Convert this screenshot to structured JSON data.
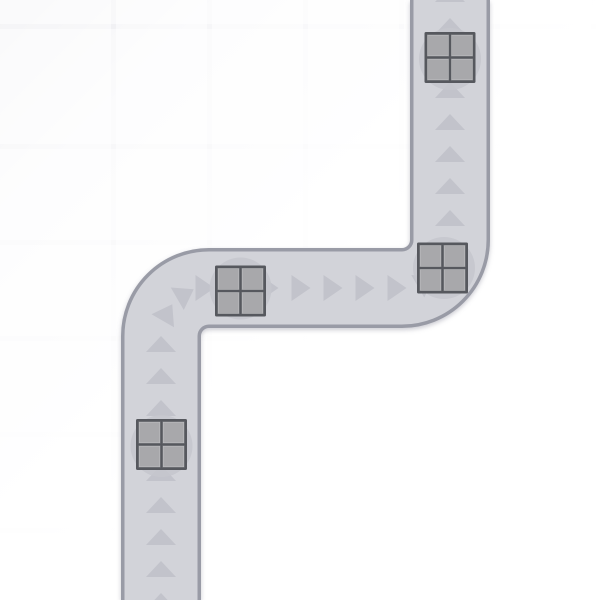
{
  "scene": {
    "canvas": {
      "width": 600,
      "height": 600
    },
    "colors": {
      "background_corner": "#e8e8ec",
      "background_mid": "#f6f6f8",
      "background": "#ffffff",
      "grid_cell_white": "rgba(255,255,255,0.5)",
      "road_fill": "#d2d3d9",
      "road_border": "#999ba6",
      "road_shadow": "#7d7d90",
      "arrow": "#c2c3cb",
      "pad_circle": "#c5c6cd",
      "crate_frame": "#56585e",
      "crate_panel": "#a8a8ab",
      "crate_panel_highlight": "rgba(255,255,255,0.25)"
    },
    "grid": {
      "cell_size": 96,
      "line_width": 5,
      "offset_x": 15,
      "offset_y": 48
    },
    "road": {
      "centerline": "M161,600 L161,336 A48,48 0 0 1 209,288 L402,288 A48,48 0 0 0 450,240 L450,0",
      "width": 73,
      "border_width": 80,
      "corner_radius": 48
    },
    "arrows": {
      "shape_up": {
        "width": 30,
        "height": 16
      },
      "shape_right": {
        "width": 19,
        "height": 26
      },
      "items": [
        {
          "x": 450,
          "y": -6,
          "dir": "up",
          "rot": 0
        },
        {
          "x": 450,
          "y": 26,
          "dir": "up",
          "rot": 0
        },
        {
          "x": 450,
          "y": 58,
          "dir": "up",
          "rot": 0
        },
        {
          "x": 450,
          "y": 90,
          "dir": "up",
          "rot": 0
        },
        {
          "x": 450,
          "y": 122,
          "dir": "up",
          "rot": 0
        },
        {
          "x": 450,
          "y": 154,
          "dir": "up",
          "rot": 0
        },
        {
          "x": 450,
          "y": 186,
          "dir": "up",
          "rot": 0
        },
        {
          "x": 450,
          "y": 218,
          "dir": "up",
          "rot": 0
        },
        {
          "x": 443.5,
          "y": 264,
          "dir": "right",
          "rot": -60
        },
        {
          "x": 426,
          "y": 281.5,
          "dir": "right",
          "rot": -30
        },
        {
          "x": 397,
          "y": 288,
          "dir": "right",
          "rot": 0
        },
        {
          "x": 365,
          "y": 288,
          "dir": "right",
          "rot": 0
        },
        {
          "x": 333,
          "y": 288,
          "dir": "right",
          "rot": 0
        },
        {
          "x": 301,
          "y": 288,
          "dir": "right",
          "rot": 0
        },
        {
          "x": 269,
          "y": 288,
          "dir": "right",
          "rot": 0
        },
        {
          "x": 237,
          "y": 288,
          "dir": "right",
          "rot": 0
        },
        {
          "x": 205,
          "y": 288,
          "dir": "right",
          "rot": 0
        },
        {
          "x": 185.5,
          "y": 294,
          "dir": "right",
          "rot": -30
        },
        {
          "x": 167.5,
          "y": 312.5,
          "dir": "right",
          "rot": -60
        },
        {
          "x": 161,
          "y": 344,
          "dir": "up",
          "rot": 0
        },
        {
          "x": 161,
          "y": 376,
          "dir": "up",
          "rot": 0
        },
        {
          "x": 161,
          "y": 408,
          "dir": "up",
          "rot": 0
        },
        {
          "x": 161,
          "y": 441,
          "dir": "up",
          "rot": 0
        },
        {
          "x": 161,
          "y": 473,
          "dir": "up",
          "rot": 0
        },
        {
          "x": 161,
          "y": 505,
          "dir": "up",
          "rot": 0
        },
        {
          "x": 161,
          "y": 537,
          "dir": "up",
          "rot": 0
        },
        {
          "x": 161,
          "y": 569,
          "dir": "up",
          "rot": 0
        },
        {
          "x": 161,
          "y": 601,
          "dir": "up",
          "rot": 0
        }
      ]
    },
    "pads": {
      "radius": 31,
      "items": [
        {
          "x": 450,
          "y": 59
        },
        {
          "x": 444,
          "y": 268
        },
        {
          "x": 240.5,
          "y": 288.5
        },
        {
          "x": 161.5,
          "y": 446
        }
      ]
    },
    "crates": {
      "size": 51,
      "frame_thickness": 3,
      "divider_thickness": 3,
      "items": [
        {
          "x": 450,
          "y": 57.5
        },
        {
          "x": 442.5,
          "y": 268
        },
        {
          "x": 240.5,
          "y": 291
        },
        {
          "x": 161.5,
          "y": 444.5
        }
      ]
    }
  }
}
